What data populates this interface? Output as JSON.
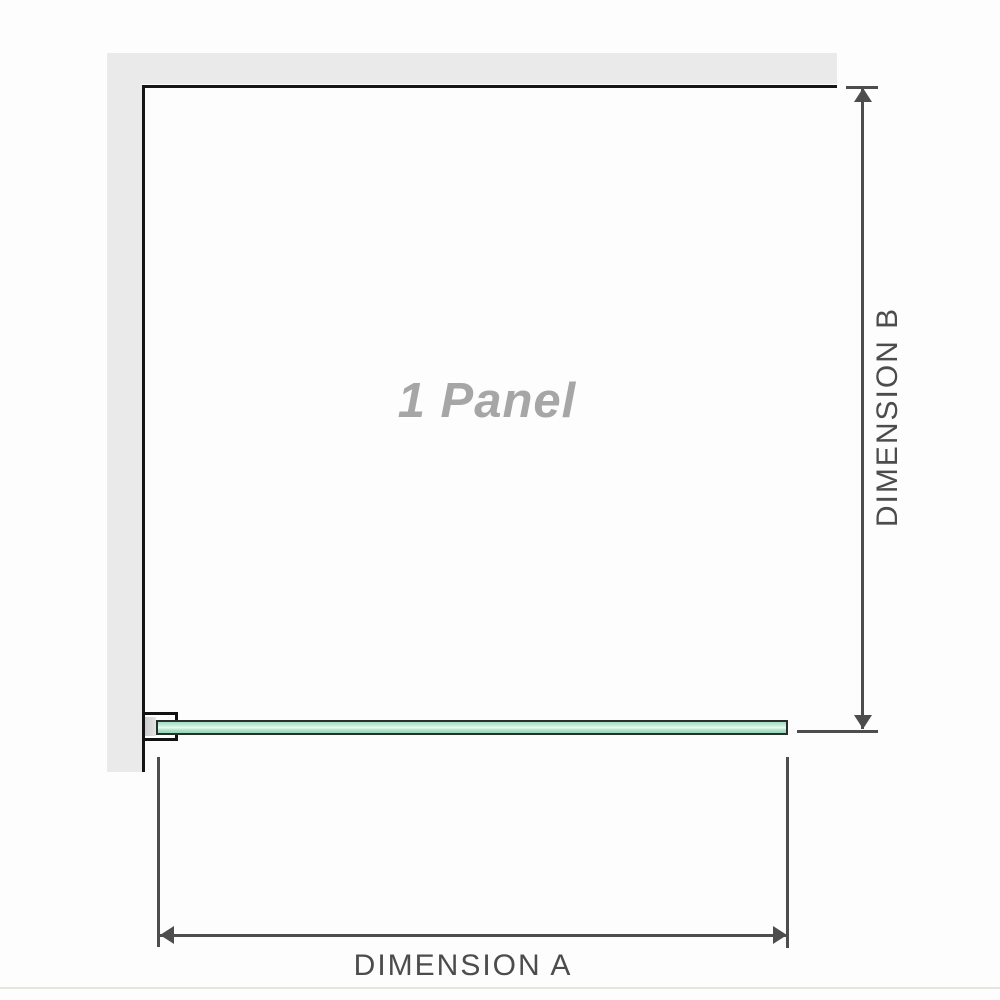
{
  "labels": {
    "panel": "1 Panel",
    "dimension_a": "DIMENSION A",
    "dimension_b": "DIMENSION B"
  },
  "colors": {
    "wall_gray": "#eaeaea",
    "frame_black": "#161616",
    "dimension_gray": "#4d4d4d",
    "dimension_text": "#4c4c4c",
    "panel_text": "#a6a6a6",
    "glass_green": "#aee3c8",
    "glass_highlight": "#eefaf4",
    "glass_border": "#2d2d2d",
    "bracket_outline": "#121212",
    "bracket_pad_gray": "#d9d9d9",
    "hairline": "#e8e5e1",
    "background": "#fdfdfd"
  }
}
